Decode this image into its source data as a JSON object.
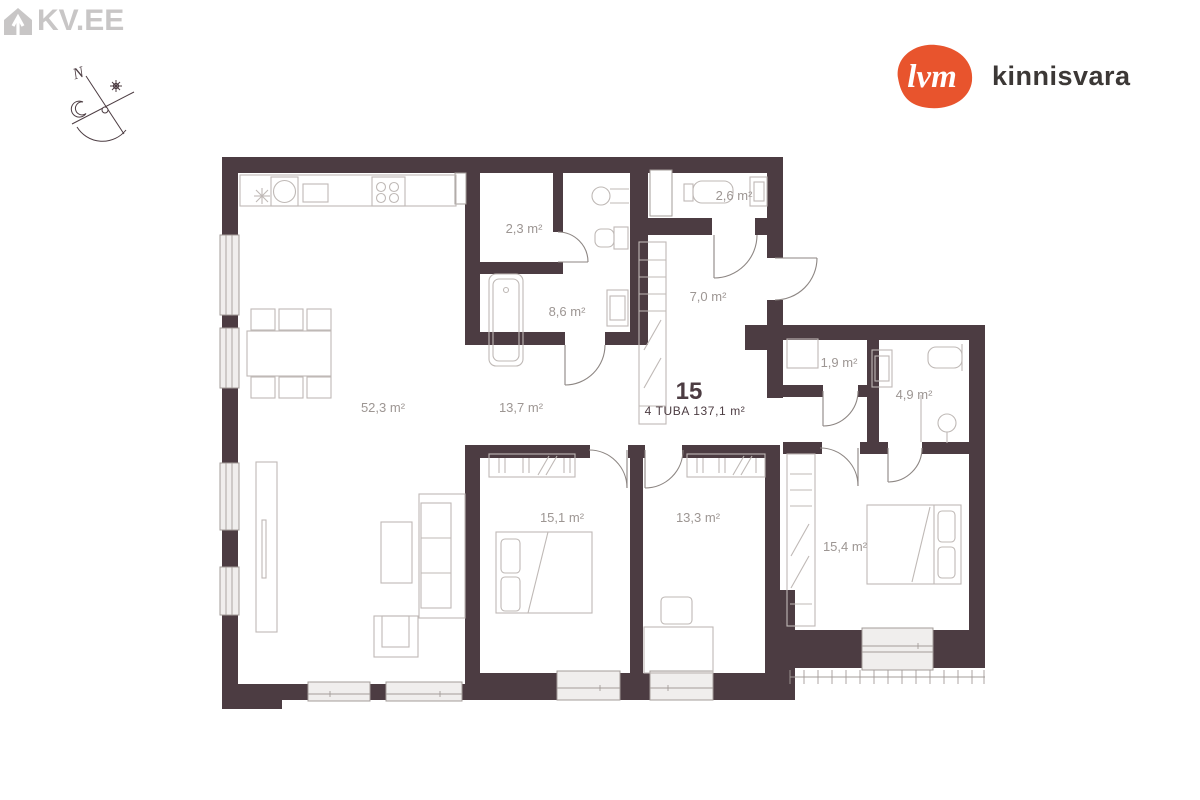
{
  "branding": {
    "kv_logo_text": "KV.EE",
    "lvm_logo_text": "lvm",
    "lvm_logo_name": "kinnisvara"
  },
  "compass": {
    "north": "N"
  },
  "apartment": {
    "number": "15",
    "summary": "4 TUBA 137,1 m²"
  },
  "rooms": [
    "52,3 m²",
    "13,7 m²",
    "2,3 m²",
    "8,6 m²",
    "7,0 m²",
    "2,6 m²",
    "1,9 m²",
    "4,9 m²",
    "15,1 m²",
    "13,3 m²",
    "15,4 m²"
  ],
  "colors": {
    "wall": "#4C3C42",
    "label": "#9D9693",
    "furniture": "#BFB9B6",
    "door": "#8D8683",
    "window_fill": "#F0EEED",
    "thin": "#A39C99",
    "kv_gray": "#C8C6C6",
    "lvm_orange": "#E8542D",
    "ink": "#3C3836"
  }
}
